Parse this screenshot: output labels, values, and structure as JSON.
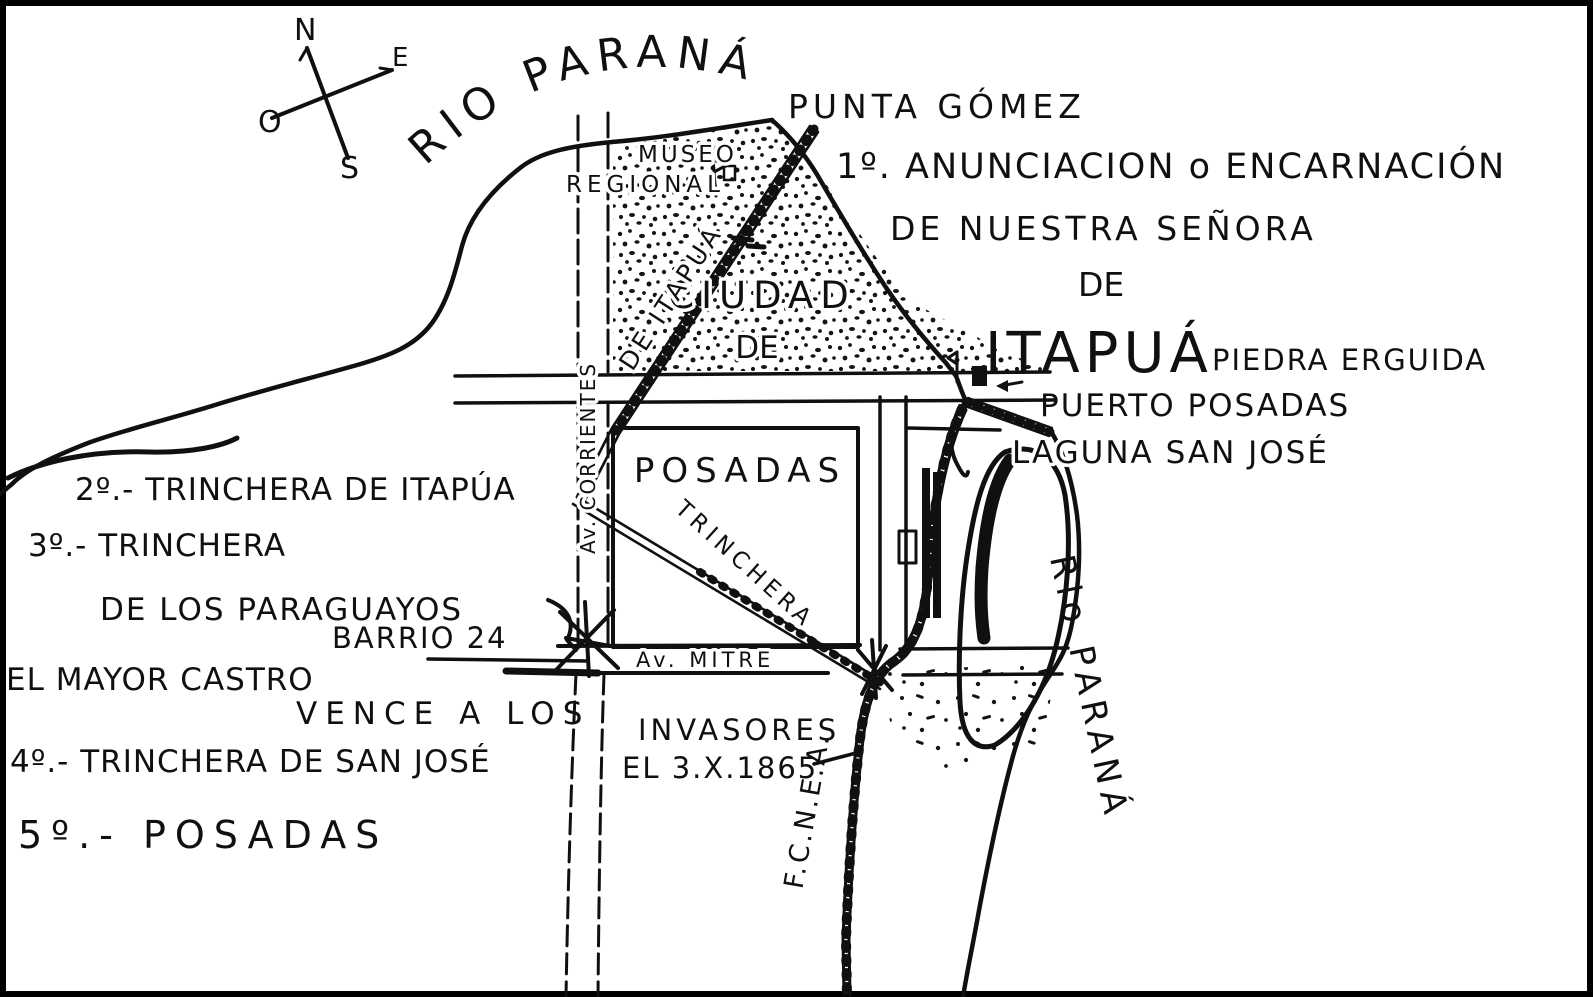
{
  "map": {
    "background_color": "#ffffff",
    "ink_color": "#101010",
    "compass": {
      "north": "N",
      "east": "E",
      "west": "O",
      "south": "S"
    },
    "rivers": {
      "top_river": "RIO PARANÁ",
      "right_river": "Rio PARANÁ"
    },
    "places": {
      "punta_gomez": "PUNTA GÓMEZ",
      "museo_line1": "MUSEO",
      "museo_line2": "REGIONAL",
      "ciudad_line1": "CIUDAD",
      "ciudad_line2": "DE",
      "ciudad_line3": "POSADAS",
      "piedra_erguida": "PIEDRA ERGUIDA",
      "puerto_posadas": "PUERTO POSADAS",
      "laguna_san_jose": "LAGUNA SAN JOSÉ"
    },
    "streets": {
      "av_corrientes": "Av. CORRIENTES",
      "av_mitre": "Av. MITRE",
      "de_itapua": "DE ITAPUÁ",
      "trinchera": "TRINCHERA",
      "railroad": "F.C.N.E.A."
    },
    "annotations": {
      "encarnacion_line1": "1º. ANUNCIACION o ENCARNACIÓN",
      "encarnacion_line2": "DE NUESTRA SEÑORA",
      "encarnacion_line3": "DE",
      "encarnacion_line4": "ITAPUÁ"
    },
    "legend": {
      "l2": "2º.- TRINCHERA DE ITAPÚA",
      "l3a": "3º.- TRINCHERA",
      "l3b": "DE LOS PARAGUAYOS",
      "l4": "4º.- TRINCHERA DE SAN JOSÉ",
      "l5": "5º.- POSADAS"
    },
    "notes": {
      "barrio": "BARRIO 24",
      "castro1": "EL MAYOR CASTRO",
      "castro2": "VENCE A LOS",
      "castro3": "INVASORES",
      "castro4": "EL 3.X.1865"
    }
  }
}
